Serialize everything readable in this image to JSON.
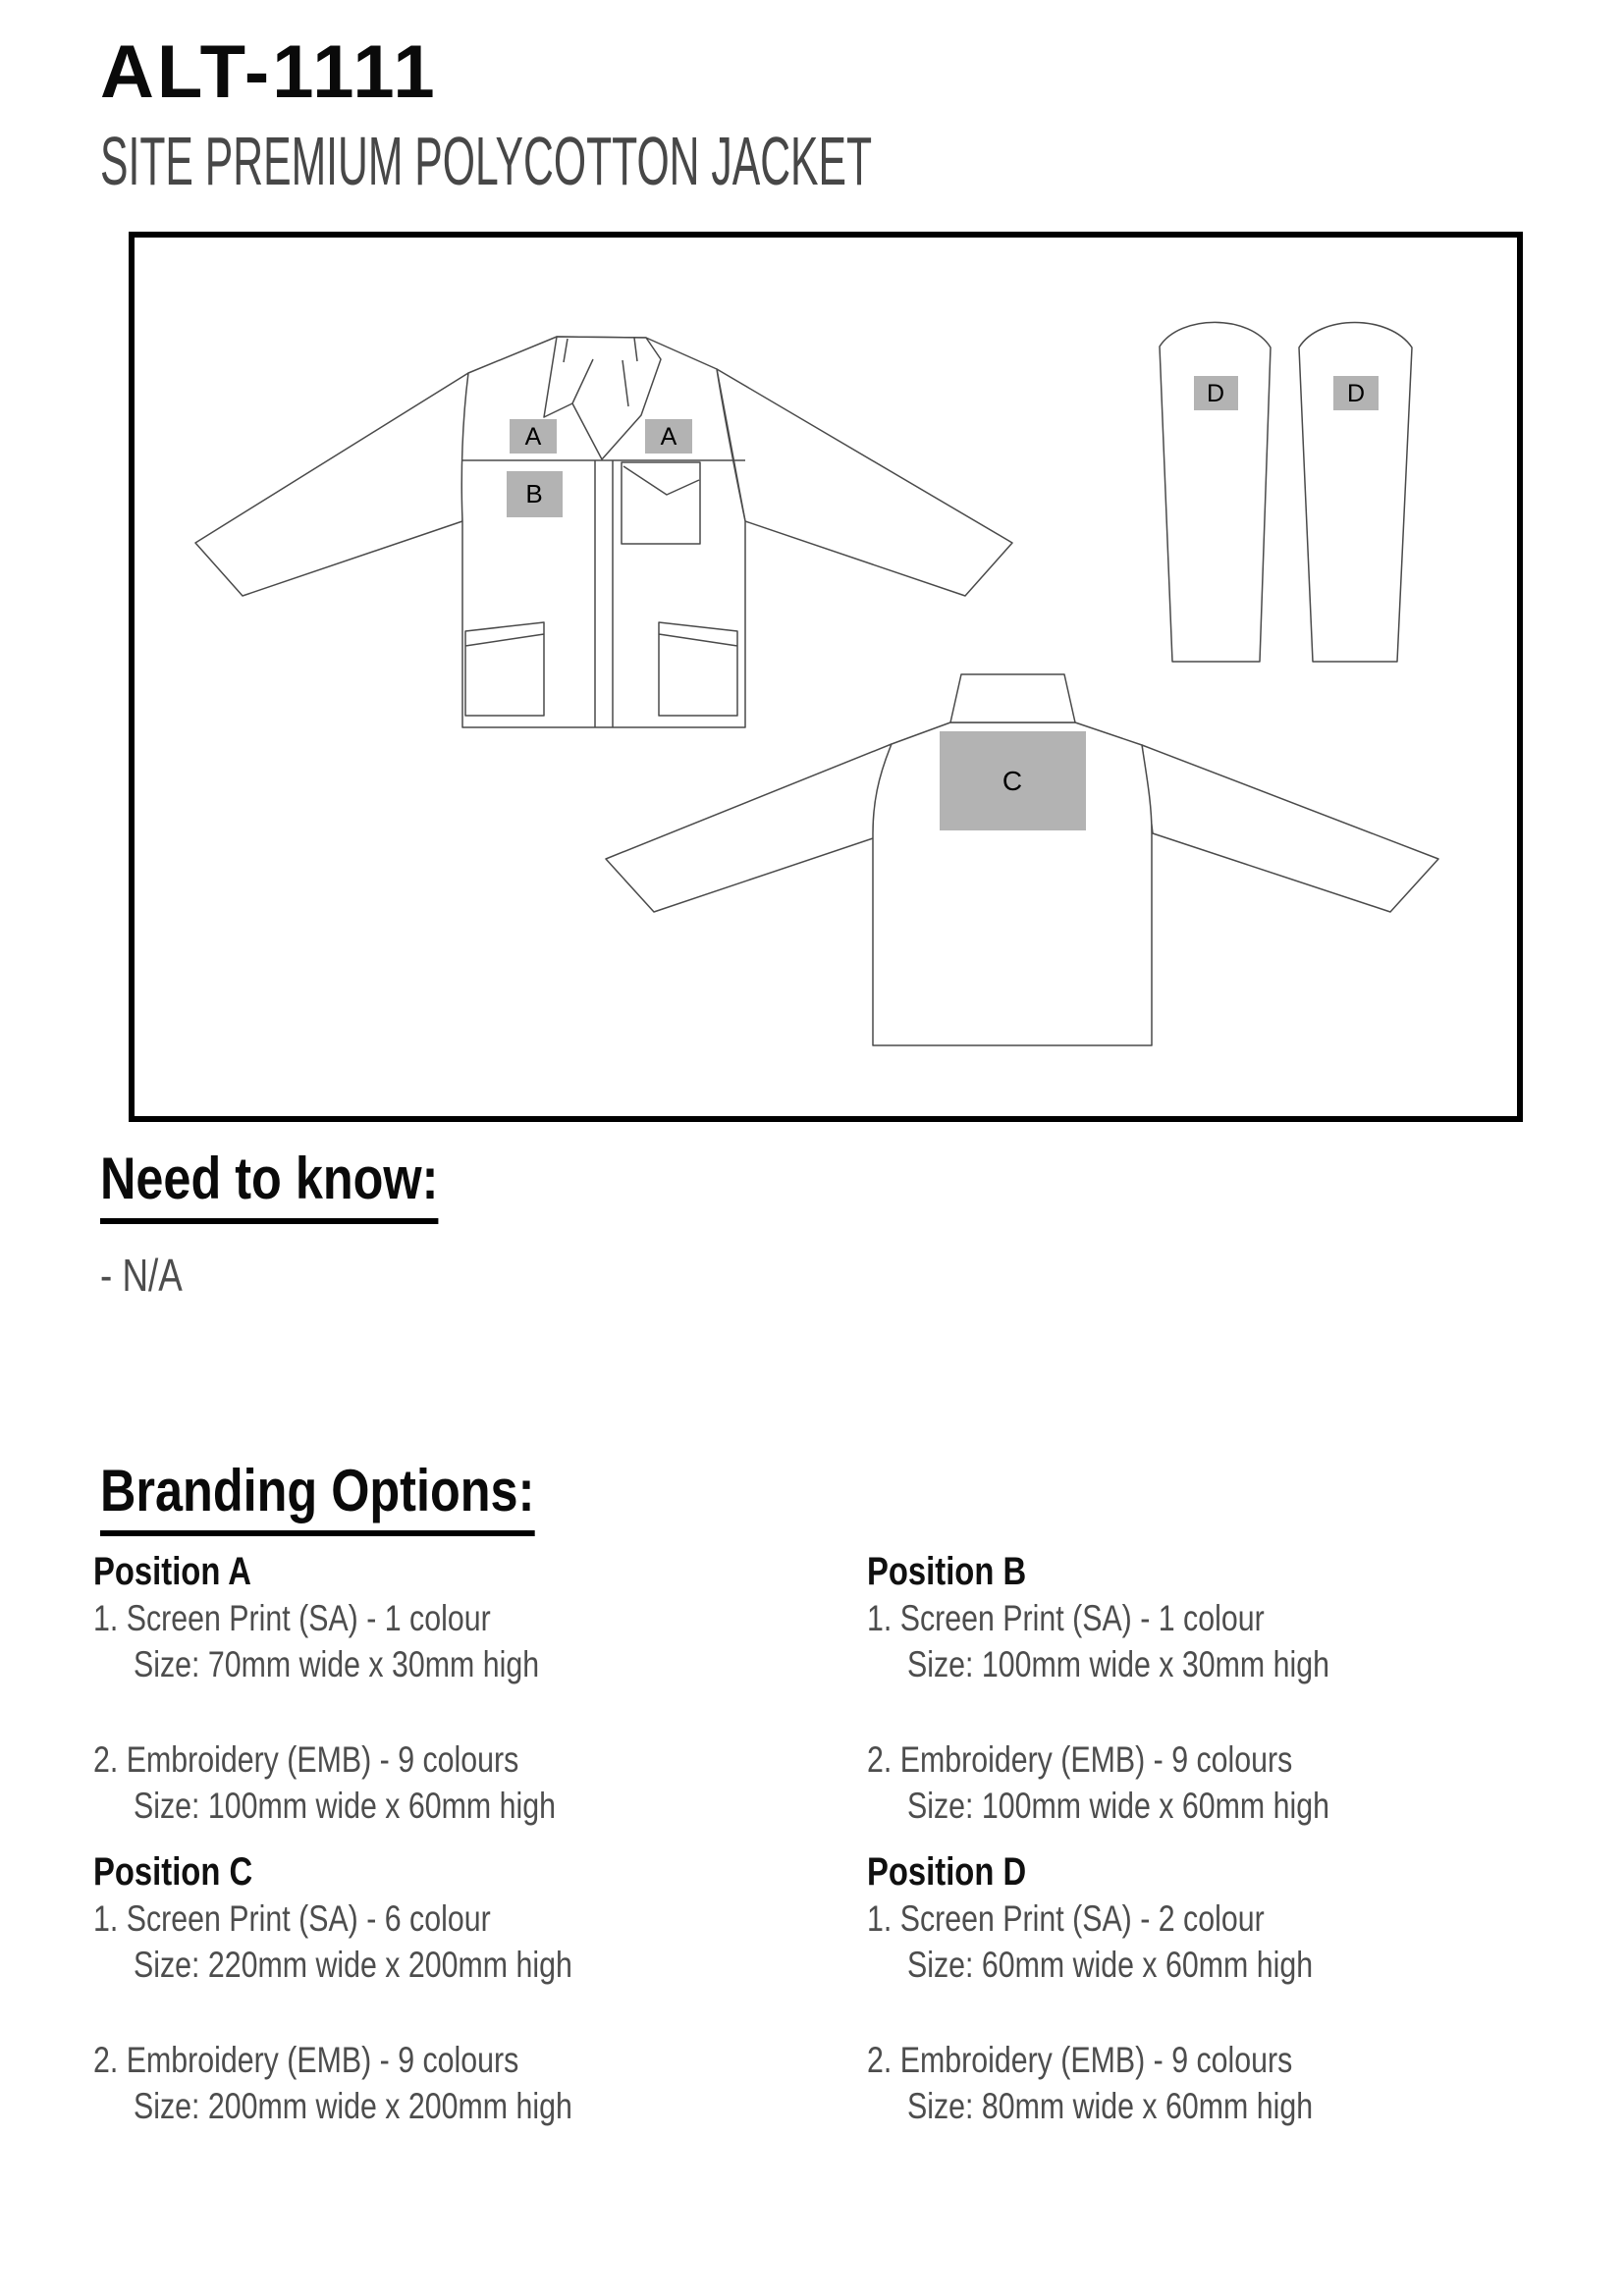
{
  "page": {
    "title": "ALT-1111",
    "subtitle": "SITE PREMIUM POLYCOTTON JACKET"
  },
  "need_to_know": {
    "heading": "Need to know:",
    "item": "- N/A"
  },
  "branding": {
    "heading": "Branding Options:",
    "positions": [
      {
        "name": "Position A",
        "option1": "1. Screen Print (SA) - 1 colour",
        "size1": "Size: 70mm wide x 30mm high",
        "option2": "2. Embroidery (EMB) - 9 colours",
        "size2": "Size: 100mm wide x 60mm high"
      },
      {
        "name": "Position B",
        "option1": "1. Screen Print (SA) - 1 colour",
        "size1": "Size: 100mm wide x 30mm high",
        "option2": "2. Embroidery (EMB) - 9 colours",
        "size2": "Size: 100mm wide x 60mm high"
      },
      {
        "name": "Position C",
        "option1": "1. Screen Print (SA) - 6 colour",
        "size1": "Size: 220mm wide x 200mm high",
        "option2": "2. Embroidery (EMB) - 9 colours",
        "size2": "Size: 200mm wide x 200mm high"
      },
      {
        "name": "Position D",
        "option1": "1. Screen Print (SA) - 2 colour",
        "size1": "Size: 60mm wide x 60mm high",
        "option2": "2. Embroidery (EMB) - 9 colours",
        "size2": "Size: 80mm wide x 60mm high"
      }
    ]
  },
  "diagram": {
    "marker_color": "#b3b3b3",
    "line_color": "#4a4a4a",
    "markers": {
      "a": "A",
      "b": "B",
      "c": "C",
      "d": "D"
    }
  }
}
